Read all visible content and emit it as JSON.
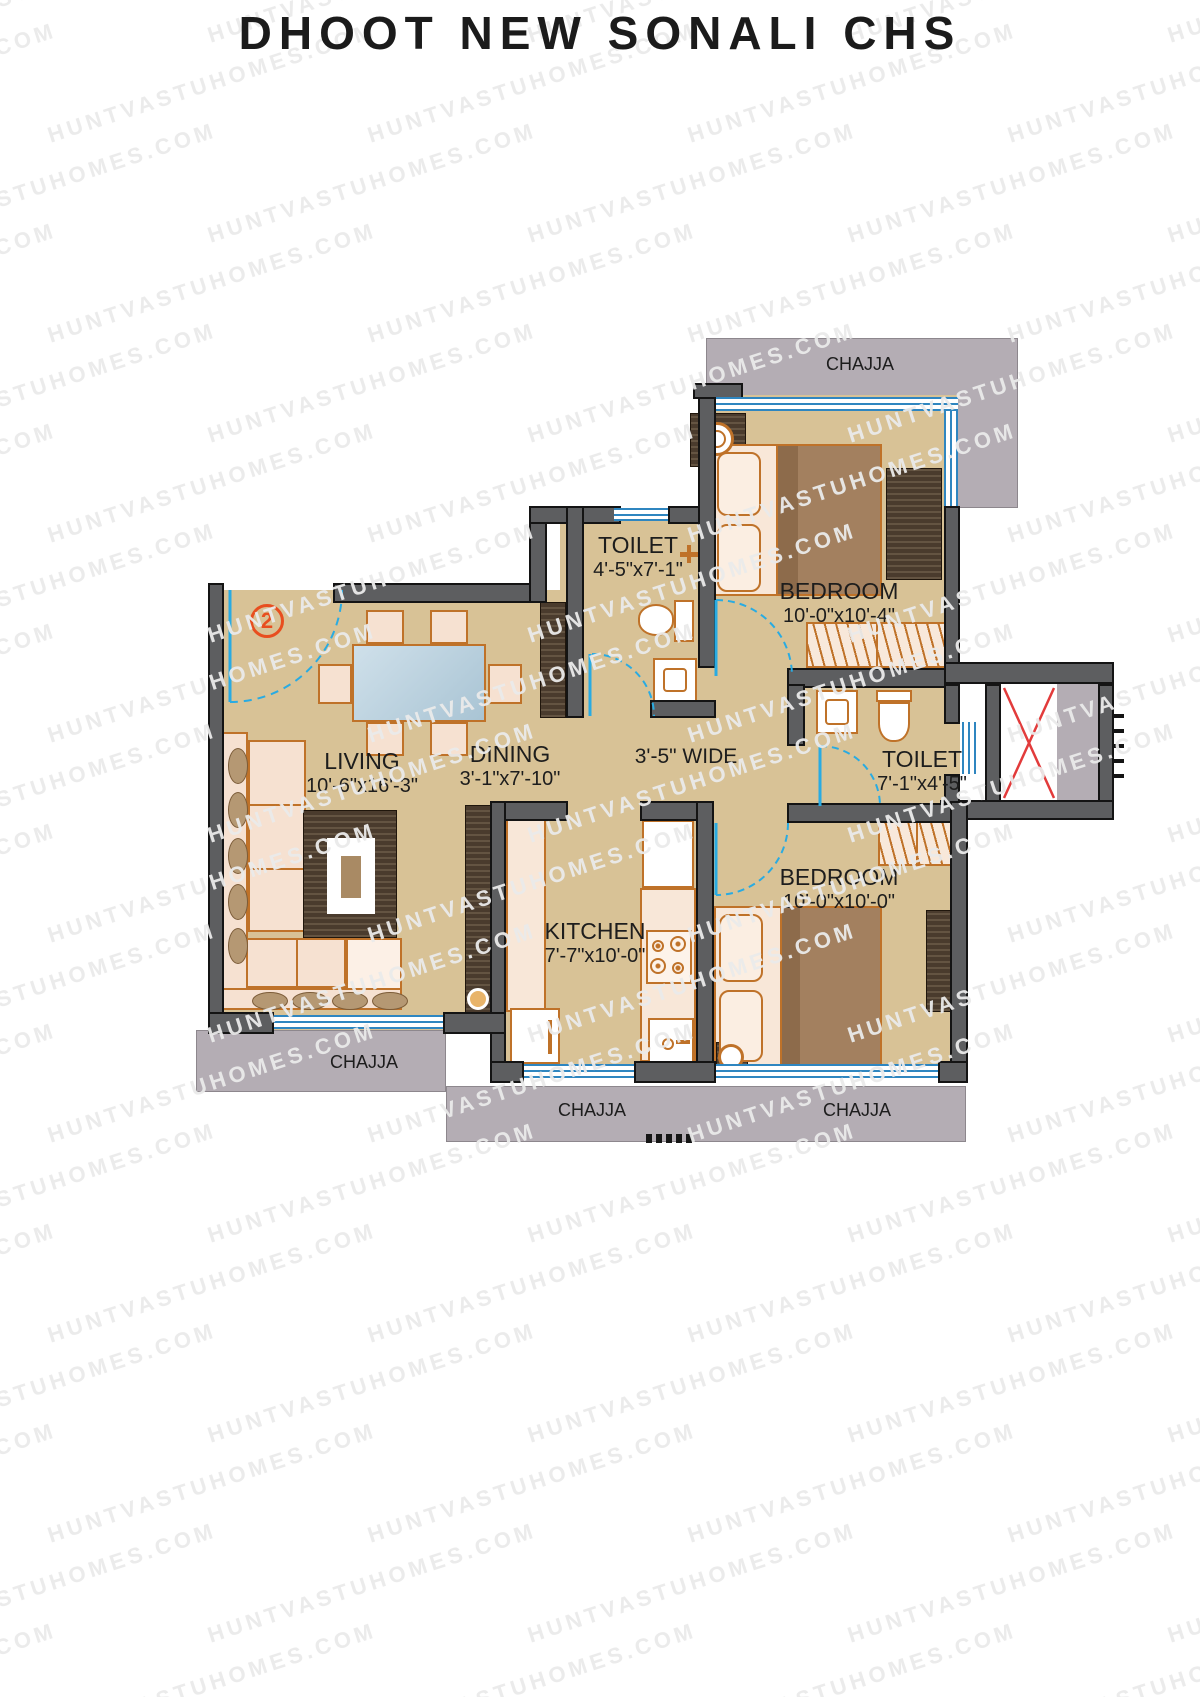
{
  "title": "DHOOT NEW SONALI CHS",
  "watermark": {
    "text": "HUNTVASTUHOMES.COM"
  },
  "entry": {
    "label": "2"
  },
  "rooms": {
    "living": {
      "name": "LIVING",
      "dims": "10'-6\"x16'-3\""
    },
    "dining": {
      "name": "DINING",
      "dims": "3'-1\"x7'-10\""
    },
    "kitchen": {
      "name": "KITCHEN",
      "dims": "7'-7\"x10'-0\""
    },
    "toilet_top": {
      "name": "TOILET",
      "dims": "4'-5\"x7'-1\""
    },
    "toilet_right": {
      "name": "TOILET",
      "dims": "7'-1\"x4'-5\""
    },
    "bedroom_top": {
      "name": "BEDROOM",
      "dims": "10'-0\"x10'-4\""
    },
    "bedroom_bottom": {
      "name": "BEDROOM",
      "dims": "10'-0\"x10'-0\""
    }
  },
  "passage": {
    "label": "3'-5\" WIDE"
  },
  "chajja": {
    "top": "CHAJJA",
    "left": "CHAJJA",
    "bottom_left": "CHAJJA",
    "bottom_right": "CHAJJA"
  },
  "colors": {
    "wall": "#5d5e60",
    "floor": "#d8c296",
    "chajja": "#b4adb4",
    "furniture_outline": "#bf7229",
    "window_blue": "#2f86c0",
    "door_cyan": "#29abe2",
    "lift_x_red": "#e23b3b",
    "entry_accent": "#e84e1f",
    "title_text": "#1b1b1b",
    "watermark_gray": "#eaeaea"
  }
}
